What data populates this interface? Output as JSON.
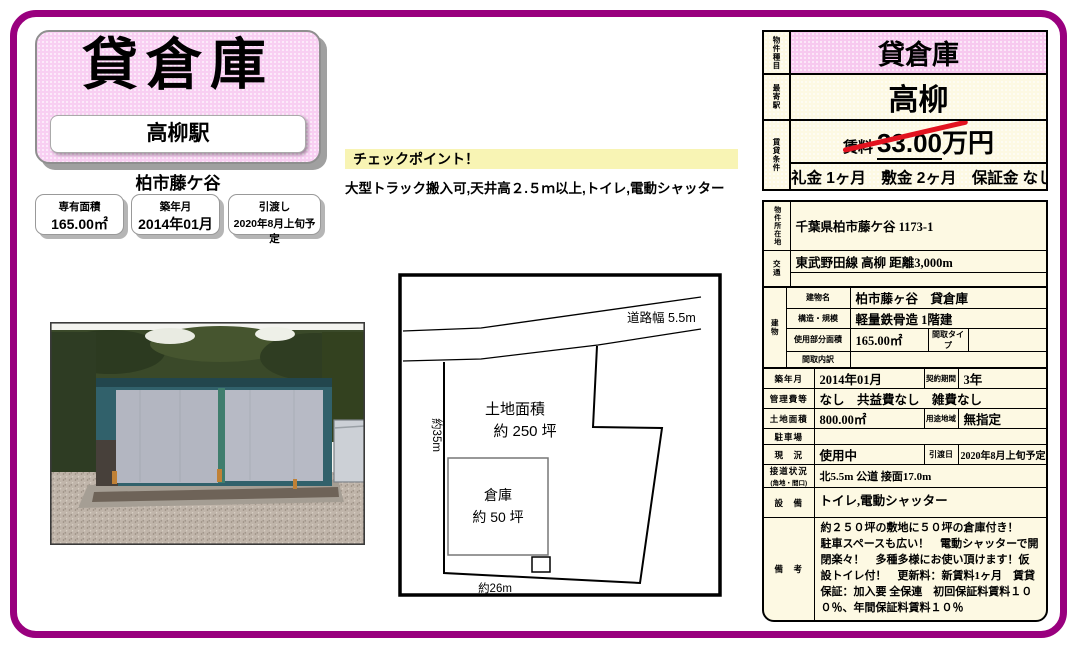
{
  "colors": {
    "frame_magenta": "#99007E",
    "title_pink": "#F8CFF2",
    "cell_pink": "#F7C9EF",
    "cream": "#FDF9E3",
    "checkpoint_yellow": "#F8F4B4",
    "strike_red": "#E2131F"
  },
  "header_left": {
    "property_type": "貸倉庫",
    "station": "高柳駅",
    "area_name": "柏市藤ケ谷",
    "stat_boxes": [
      {
        "label": "専有面積",
        "value": "165.00㎡"
      },
      {
        "label": "築年月",
        "value": "2014年01月"
      },
      {
        "label": "引渡し",
        "value": "2020年8月上旬予定"
      }
    ]
  },
  "checkpoint": {
    "title": "チェックポイント！",
    "text": "大型トラック搬入可,天井高２.５ｍ以上,トイレ,電動シャッター"
  },
  "summary": {
    "type_label": "物件種目",
    "type_value": "貸倉庫",
    "station_label": "最寄駅",
    "station_value": "高柳",
    "terms_label": "賃貸条件",
    "rent_label": "賃料",
    "rent_value": "33.00",
    "rent_unit": "万円",
    "terms": "礼金 1ヶ月　敷金 2ヶ月　保証金 なし"
  },
  "details": {
    "location_label": "物件所在地",
    "location": "千葉県柏市藤ケ谷 1173-1",
    "transport_label": "交通",
    "transport": "東武野田線 高柳 距離3,000m",
    "transport2": "",
    "building_label": "建物",
    "building_name_label": "建物名",
    "building_name": "柏市藤ヶ谷　貸倉庫",
    "structure_label": "構造・規模",
    "structure": "軽量鉄骨造 1階建",
    "used_area_label": "使用部分面積",
    "used_area": "165.00㎡",
    "madori_type_label": "間取タイプ",
    "madori_type": "",
    "madori_breakdown_label": "間取内訳",
    "madori_breakdown": "",
    "built_label": "築年月",
    "built": "2014年01月",
    "contract_label": "契約期間",
    "contract": "3年",
    "mgmt_label": "管理費等",
    "mgmt": "なし　共益費なし　雑費なし",
    "land_label": "土地面積",
    "land": "800.00㎡",
    "zoning_label": "用途地域",
    "zoning": "無指定",
    "parking_label": "駐車場",
    "parking": "",
    "status_label": "現　況",
    "status": "使用中",
    "handover_label": "引渡日",
    "handover": "2020年8月上旬予定",
    "road_label": "接道状況",
    "road_sublabel": "(角地・間口)",
    "road": "北5.5m 公道 接面17.0m",
    "equipment_label": "設　備",
    "equipment": "トイレ,電動シャッター",
    "remarks_label": "備　考",
    "remarks": "約２５０坪の敷地に５０坪の倉庫付き！　駐車スペースも広い！　電動シャッターで開閉楽々！　多種多様にお使い頂けます！仮設トイレ付！　更新料：新賃料1ヶ月　賃貸保証：加入要 全保連　初回保証料賃料１００％、年間保証料賃料１０％"
  },
  "site_plan": {
    "road_width": "道路幅  5.5m",
    "land_area_line1": "土地面積",
    "land_area_line2": "約  250  坪",
    "warehouse_line1": "倉庫",
    "warehouse_line2": "約  50  坪",
    "depth": "約35m",
    "width": "約26m"
  }
}
